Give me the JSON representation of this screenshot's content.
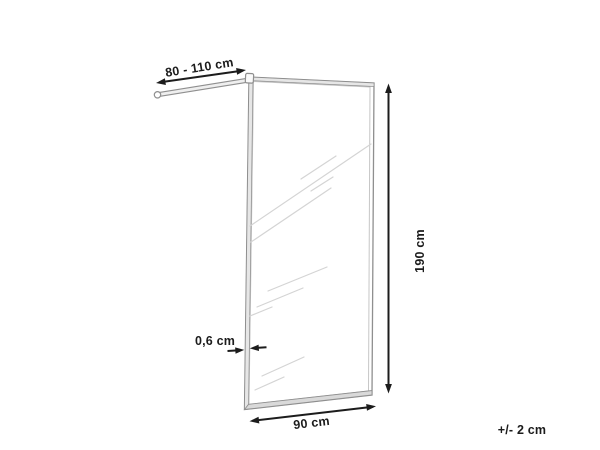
{
  "diagram": {
    "labels": {
      "bar_length": "80 - 110 cm",
      "height": "190 cm",
      "glass_thickness": "0,6 cm",
      "width": "90 cm",
      "tolerance": "+/- 2 cm"
    },
    "colors": {
      "dimension": "#1c1c1c",
      "frame_line": "#8f8f8f",
      "frame_inner_line": "#c6c6c6",
      "frame_fill": "#e6e6e6",
      "bottom_rail_fill": "#d9d9d9",
      "reflection": "#d4d4d4",
      "background": "#ffffff"
    }
  }
}
